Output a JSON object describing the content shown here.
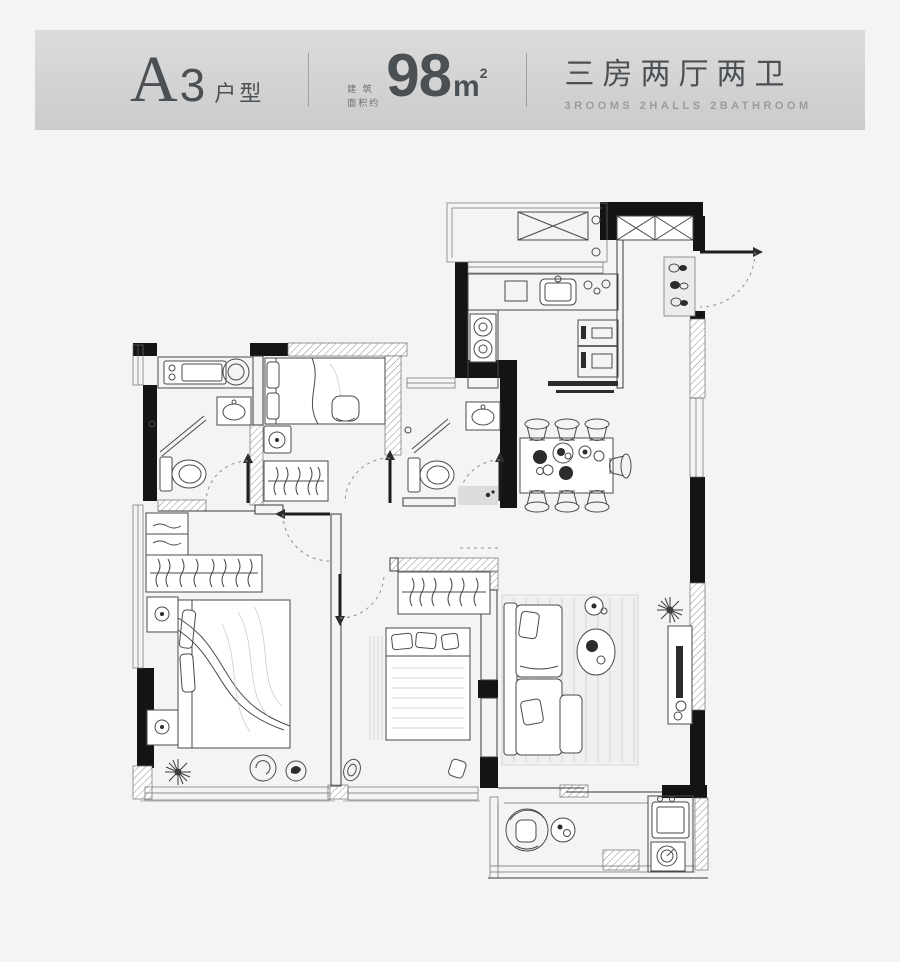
{
  "theme": {
    "page-bg": "#f4f4f3",
    "header-from": "#dcdcdc",
    "header-to": "#cbcbcb",
    "ink": "#3a3a3a",
    "wall": "#141414",
    "text": "#4b5055",
    "muted": "#9b9b9b",
    "soft": "#8a8a8a"
  },
  "header": {
    "unit_letter": "A",
    "unit_number": "3",
    "unit_suffix": "户型",
    "area_prefix_line1": "建 筑",
    "area_prefix_line2": "面积约",
    "area_value": "98",
    "area_unit": "m",
    "area_sup": "2",
    "rooms_cn": "三房两厅两卫",
    "rooms_en": "3ROOMS 2HALLS 2BATHROOM"
  }
}
